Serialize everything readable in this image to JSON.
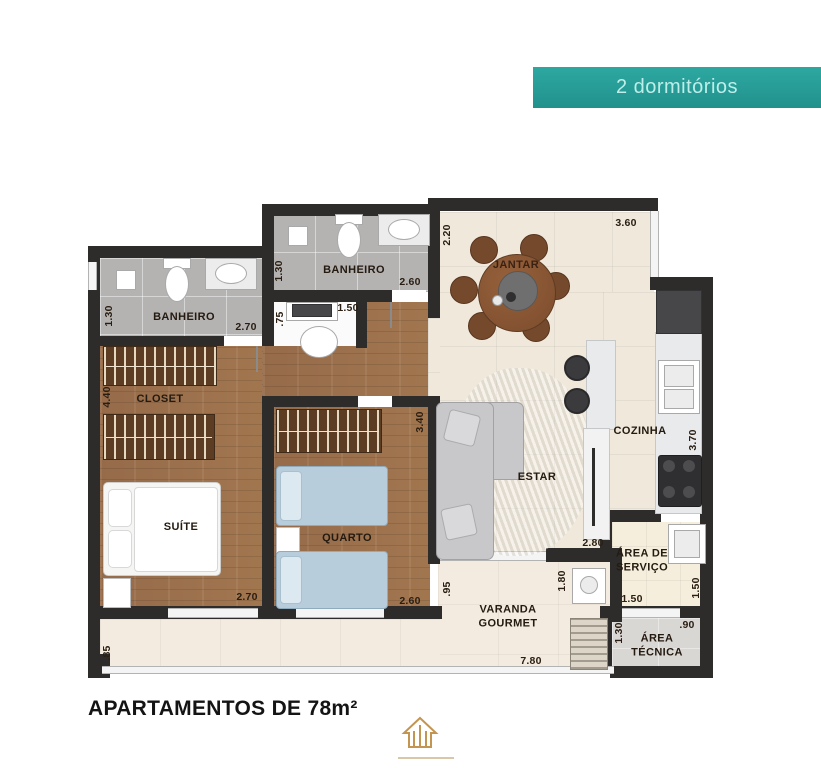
{
  "banner": {
    "label": "2 dormitórios"
  },
  "footer": {
    "title": "APARTAMENTOS DE 78m²"
  },
  "rooms": {
    "banheiro_suite": "BANHEIRO",
    "banheiro_social": "BANHEIRO",
    "closet": "CLOSET",
    "suite": "SUÍTE",
    "quarto": "QUARTO",
    "jantar": "JANTAR",
    "estar": "ESTAR",
    "cozinha": "COZINHA",
    "area_servico": "ÁREA DE SERVIÇO",
    "varanda": "VARANDA GOURMET",
    "area_tecnica": "ÁREA TÉCNICA"
  },
  "dimensions": {
    "banheiro1_h": "1.30",
    "banheiro1_w": "2.70",
    "closet_h": "4.40",
    "suite_w": "2.70",
    "varanda_left_h": ".85",
    "banheiro2_h": "1.30",
    "banheiro2_w": "2.60",
    "desk_w": "1.50",
    "desk_h": ".75",
    "jantar_h": "2.20",
    "jantar_w": "3.60",
    "quarto_h": "3.40",
    "quarto_w": "2.60",
    "estar_w": "2.80",
    "cozinha_h": "3.70",
    "servico_w": "1.50",
    "servico_h": "1.50",
    "varanda_h": ".95",
    "varanda_sink_h": "1.80",
    "varanda_w": "7.80",
    "tecnica_h": "1.30",
    "tecnica_w": ".90"
  },
  "colors": {
    "banner_bg": "#2aa19b",
    "wall": "#2e2c2b",
    "wood_floor": "#9b7150",
    "logo_gold": "#c49550"
  }
}
